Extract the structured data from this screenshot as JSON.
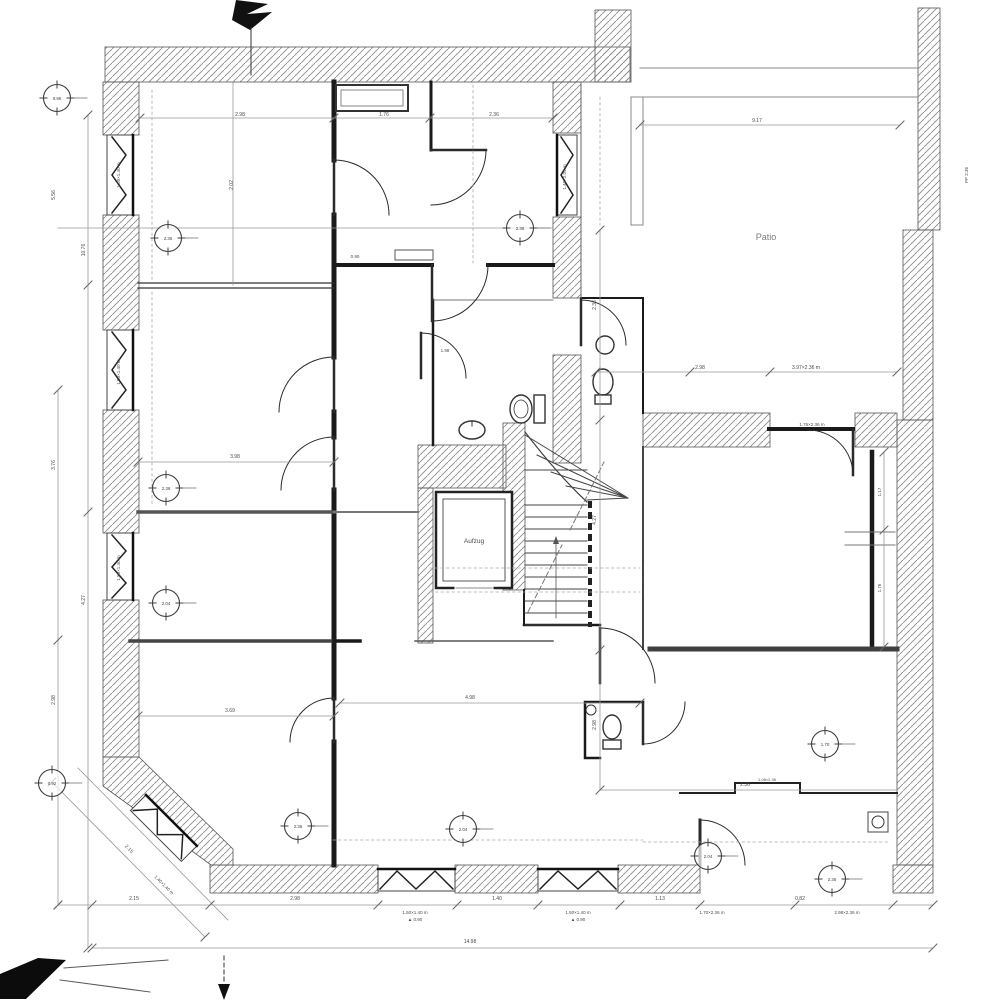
{
  "drawing": {
    "kind": "architectural-floor-plan-scan",
    "room_labels": {
      "elevator": "Aufzug",
      "courtyard": "Patio"
    }
  },
  "colors": {
    "paper": "#ffffff",
    "ink": "#2b2b2b",
    "heavy_wall": "#161616",
    "hatch": "#8c8c8c",
    "dim_line": "#999999",
    "annotation": "#4a4a4a"
  },
  "texts": [
    {
      "x": 766,
      "y": 240,
      "s": 9,
      "t": "Patio",
      "c": "#7d7d7d"
    },
    {
      "x": 474,
      "y": 543,
      "s": 6.5,
      "t": "Aufzug"
    },
    {
      "x": 240,
      "y": 116,
      "s": 5,
      "t": "2.98"
    },
    {
      "x": 384,
      "y": 116,
      "s": 5,
      "t": "1.76"
    },
    {
      "x": 494,
      "y": 116,
      "s": 5,
      "t": "2.36"
    },
    {
      "x": 757,
      "y": 122,
      "s": 5,
      "t": "9.17"
    },
    {
      "x": 700,
      "y": 369,
      "s": 5,
      "t": "2.98"
    },
    {
      "x": 806,
      "y": 369,
      "s": 5,
      "t": "3.97×2.36 m"
    },
    {
      "x": 812,
      "y": 426,
      "s": 4.5,
      "t": "1.76×2.36 m"
    },
    {
      "x": 55,
      "y": 195,
      "s": 5,
      "r": -90,
      "t": "5.56"
    },
    {
      "x": 55,
      "y": 465,
      "s": 5,
      "r": -90,
      "t": "3.76"
    },
    {
      "x": 55,
      "y": 700,
      "s": 5,
      "r": -90,
      "t": "2.98"
    },
    {
      "x": 85,
      "y": 250,
      "s": 5,
      "r": -90,
      "t": "10.76"
    },
    {
      "x": 85,
      "y": 600,
      "s": 5,
      "r": -90,
      "t": "4.27"
    },
    {
      "x": 233,
      "y": 185,
      "s": 5,
      "r": -90,
      "t": "2.02"
    },
    {
      "x": 120,
      "y": 175,
      "s": 4.5,
      "r": -90,
      "t": "1.50×1.40 m"
    },
    {
      "x": 120,
      "y": 372,
      "s": 4.5,
      "r": -90,
      "t": "1.50×1.40 m"
    },
    {
      "x": 120,
      "y": 568,
      "s": 4.5,
      "r": -90,
      "t": "1.50×1.40 m"
    },
    {
      "x": 566,
      "y": 177,
      "s": 4.5,
      "r": -90,
      "t": "1.40×2.04 m"
    },
    {
      "x": 968,
      "y": 175,
      "s": 4.5,
      "r": -90,
      "t": "PP 2.36"
    },
    {
      "x": 235,
      "y": 458,
      "s": 5,
      "t": "3.98"
    },
    {
      "x": 230,
      "y": 712,
      "s": 5,
      "t": "3.69"
    },
    {
      "x": 470,
      "y": 699,
      "s": 5,
      "t": "4.98"
    },
    {
      "x": 596,
      "y": 305,
      "s": 5,
      "r": -90,
      "t": "2.36"
    },
    {
      "x": 596,
      "y": 520,
      "s": 5,
      "r": -90,
      "t": "4.27"
    },
    {
      "x": 596,
      "y": 725,
      "s": 5,
      "r": -90,
      "t": "2.98"
    },
    {
      "x": 881,
      "y": 492,
      "s": 4.5,
      "r": -90,
      "t": "1.17"
    },
    {
      "x": 881,
      "y": 588,
      "s": 4.5,
      "r": -90,
      "t": "1.76"
    },
    {
      "x": 134,
      "y": 900,
      "s": 5,
      "t": "2.15"
    },
    {
      "x": 295,
      "y": 900,
      "s": 5,
      "t": "2.98"
    },
    {
      "x": 497,
      "y": 900,
      "s": 5,
      "t": "1.40"
    },
    {
      "x": 660,
      "y": 900,
      "s": 5,
      "t": "1.13"
    },
    {
      "x": 800,
      "y": 900,
      "s": 5,
      "t": "0.82"
    },
    {
      "x": 415,
      "y": 914,
      "s": 4.5,
      "t": "1.50×1.40 m"
    },
    {
      "x": 415,
      "y": 921,
      "s": 4.5,
      "t": "▲ 0.90"
    },
    {
      "x": 578,
      "y": 914,
      "s": 4.5,
      "t": "1.50×1.40 m"
    },
    {
      "x": 578,
      "y": 921,
      "s": 4.5,
      "t": "▲ 0.90"
    },
    {
      "x": 712,
      "y": 914,
      "s": 4.5,
      "t": "1.70×2.36 m"
    },
    {
      "x": 847,
      "y": 914,
      "s": 4.5,
      "t": "2.98×2.36 m"
    },
    {
      "x": 470,
      "y": 943,
      "s": 5,
      "t": "14.98"
    },
    {
      "x": 128,
      "y": 850,
      "s": 5,
      "r": 45,
      "t": "2.15"
    },
    {
      "x": 163,
      "y": 886,
      "s": 4.5,
      "r": 45,
      "t": "1.40×1.40 m"
    },
    {
      "x": 745,
      "y": 786,
      "s": 5,
      "t": "2.36"
    },
    {
      "x": 767,
      "y": 781,
      "s": 4,
      "t": "1.08×2.36"
    },
    {
      "x": 445,
      "y": 352,
      "s": 4.5,
      "t": "1.98"
    },
    {
      "x": 355,
      "y": 258,
      "s": 4.5,
      "t": "0.90"
    }
  ],
  "level_markers": [
    {
      "x": 57,
      "y": 98,
      "t": "0.96"
    },
    {
      "x": 168,
      "y": 238,
      "t": "2.36"
    },
    {
      "x": 520,
      "y": 228,
      "t": "2.36"
    },
    {
      "x": 166,
      "y": 488,
      "t": "2.36"
    },
    {
      "x": 166,
      "y": 603,
      "t": "2.04"
    },
    {
      "x": 52,
      "y": 783,
      "t": "0.92"
    },
    {
      "x": 298,
      "y": 826,
      "t": "2.36"
    },
    {
      "x": 463,
      "y": 829,
      "t": "2.04"
    },
    {
      "x": 825,
      "y": 744,
      "t": "1.70"
    },
    {
      "x": 832,
      "y": 879,
      "t": "2.36"
    },
    {
      "x": 708,
      "y": 856,
      "t": "2.04"
    }
  ]
}
